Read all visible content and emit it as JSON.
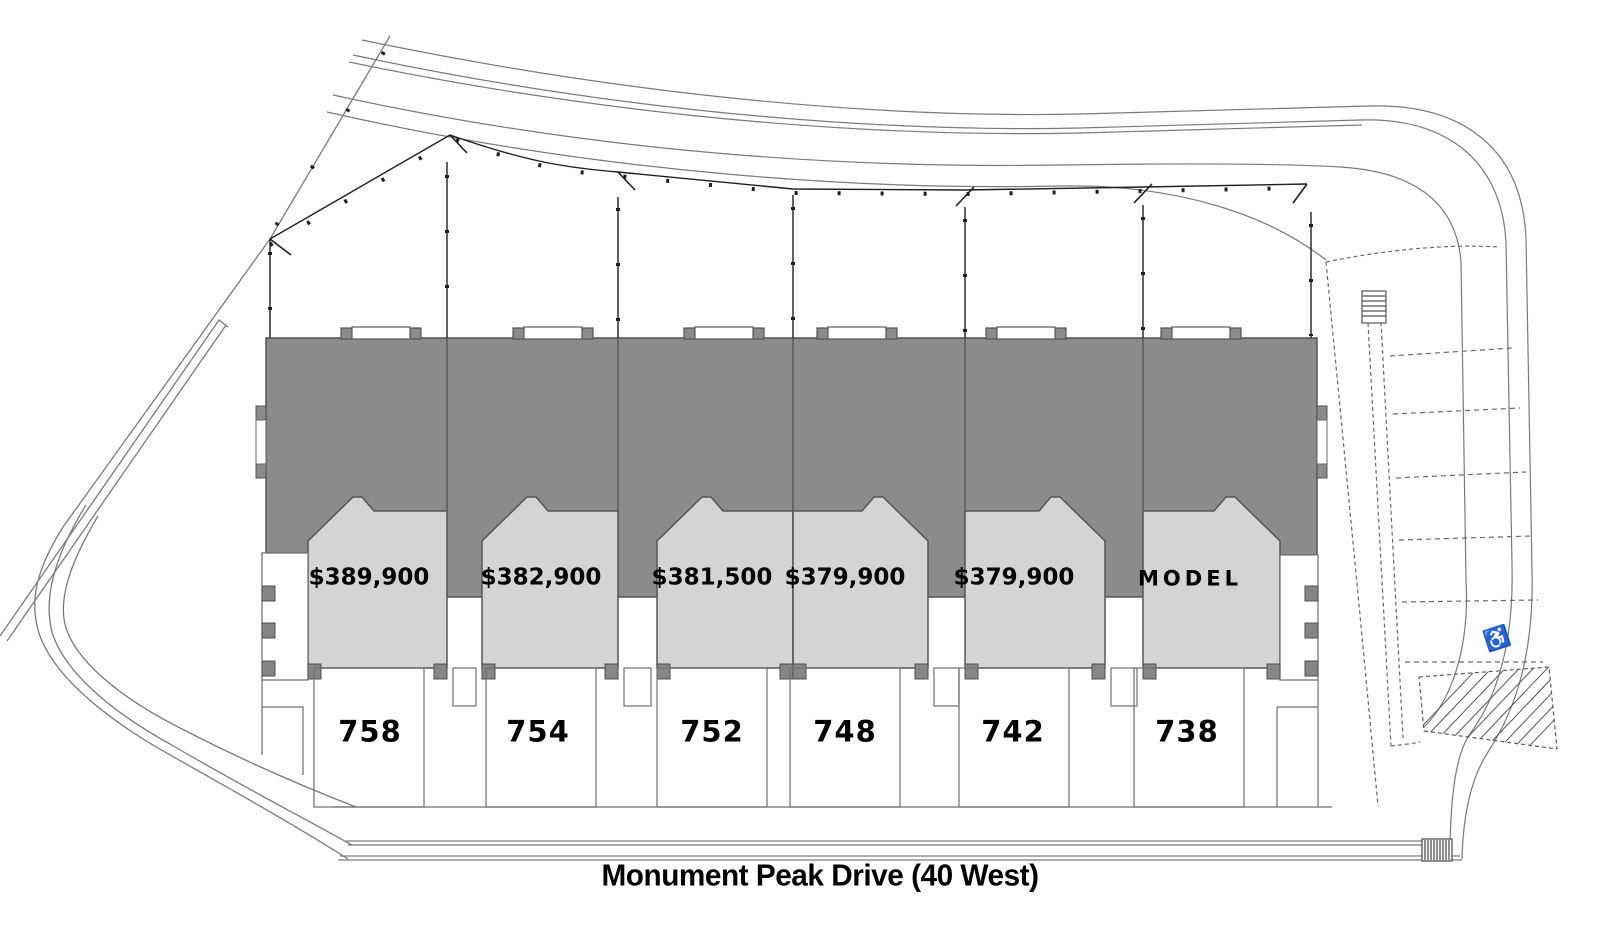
{
  "site_plan": {
    "street_label": "Monument Peak Drive (40 West)",
    "units": [
      {
        "address": "758",
        "label": "$389,900"
      },
      {
        "address": "754",
        "label": "$382,900"
      },
      {
        "address": "752",
        "label": "$381,500"
      },
      {
        "address": "748",
        "label": "$379,900"
      },
      {
        "address": "742",
        "label": "$379,900"
      },
      {
        "address": "738",
        "label": "MODEL"
      }
    ],
    "icons": {
      "accessible_parking": "♿"
    },
    "colors": {
      "building_rear": "#8b8b8b",
      "unit_front": "#d4d4d4",
      "building_outline": "#545454",
      "survey_line": "#1f1f1f",
      "road_line": "#7a7a7a",
      "background": "#ffffff",
      "label_text": "#000000"
    }
  }
}
